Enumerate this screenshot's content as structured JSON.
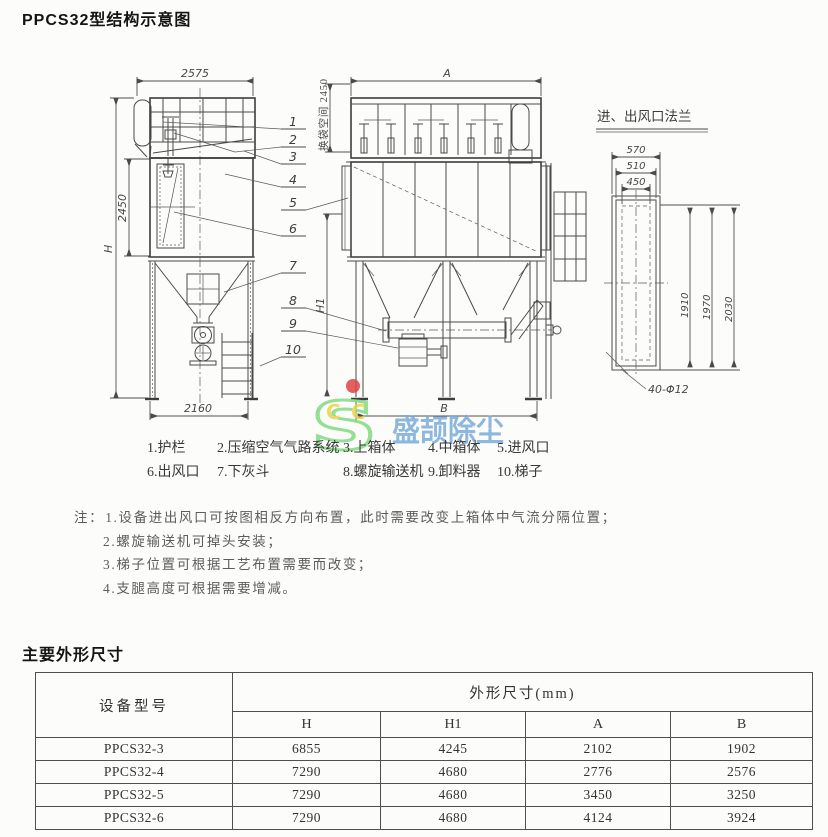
{
  "page": {
    "title": "PPCS32型结构示意图",
    "dimensions_section_title": "主要外形尺寸"
  },
  "drawing": {
    "flange_title": "进、出风口法兰",
    "dims": {
      "side_top_width": "2575",
      "side_mid_height": "2450",
      "overall_height": "H",
      "side_base_width": "2160",
      "headroom": "换袋空间 2450",
      "front_width": "A",
      "front_base_width": "B",
      "support_height": "H1",
      "flange_outer_width": "570",
      "flange_mid_width": "510",
      "flange_inner_width": "450",
      "flange_height_inner": "1910",
      "flange_height_mid": "1970",
      "flange_height_outer": "2030",
      "bolt_spec": "40-Φ12"
    },
    "part_numbers": [
      "1",
      "2",
      "3",
      "4",
      "5",
      "6",
      "7",
      "8",
      "9",
      "10"
    ]
  },
  "legend": {
    "items": [
      "1.护栏",
      "2.压缩空气气路系统",
      "3.上箱体",
      "4.中箱体",
      "5.进风口",
      "6.出风口",
      "7.下灰斗",
      "8.螺旋输送机",
      "9.卸料器",
      "10.梯子"
    ]
  },
  "notes": {
    "prefix": "注：",
    "items": [
      "1.设备进出风口可按图相反方向布置，此时需要改变上箱体中气流分隔位置；",
      "2.螺旋输送机可掉头安装；",
      "3.梯子位置可根据工艺布置需要而改变；",
      "4.支腿高度可根据需要增减。"
    ]
  },
  "watermark": {
    "text": "盛颉除尘",
    "logo_letter": "S",
    "sub_letters": [
      "C",
      "C"
    ],
    "colors": {
      "logo_green": "#82db82",
      "dot_red": "#e04444",
      "letter_yellow": "#e9d54d",
      "text_blue": "#7aabdb"
    }
  },
  "table": {
    "model_header": "设备型号",
    "group_header": "外形尺寸(mm)",
    "sub_headers": [
      "H",
      "H1",
      "A",
      "B"
    ],
    "rows": [
      {
        "model": "PPCS32-3",
        "values": [
          "6855",
          "4245",
          "2102",
          "1902"
        ]
      },
      {
        "model": "PPCS32-4",
        "values": [
          "7290",
          "4680",
          "2776",
          "2576"
        ]
      },
      {
        "model": "PPCS32-5",
        "values": [
          "7290",
          "4680",
          "3450",
          "3250"
        ]
      },
      {
        "model": "PPCS32-6",
        "values": [
          "7290",
          "4680",
          "4124",
          "3924"
        ]
      }
    ]
  }
}
